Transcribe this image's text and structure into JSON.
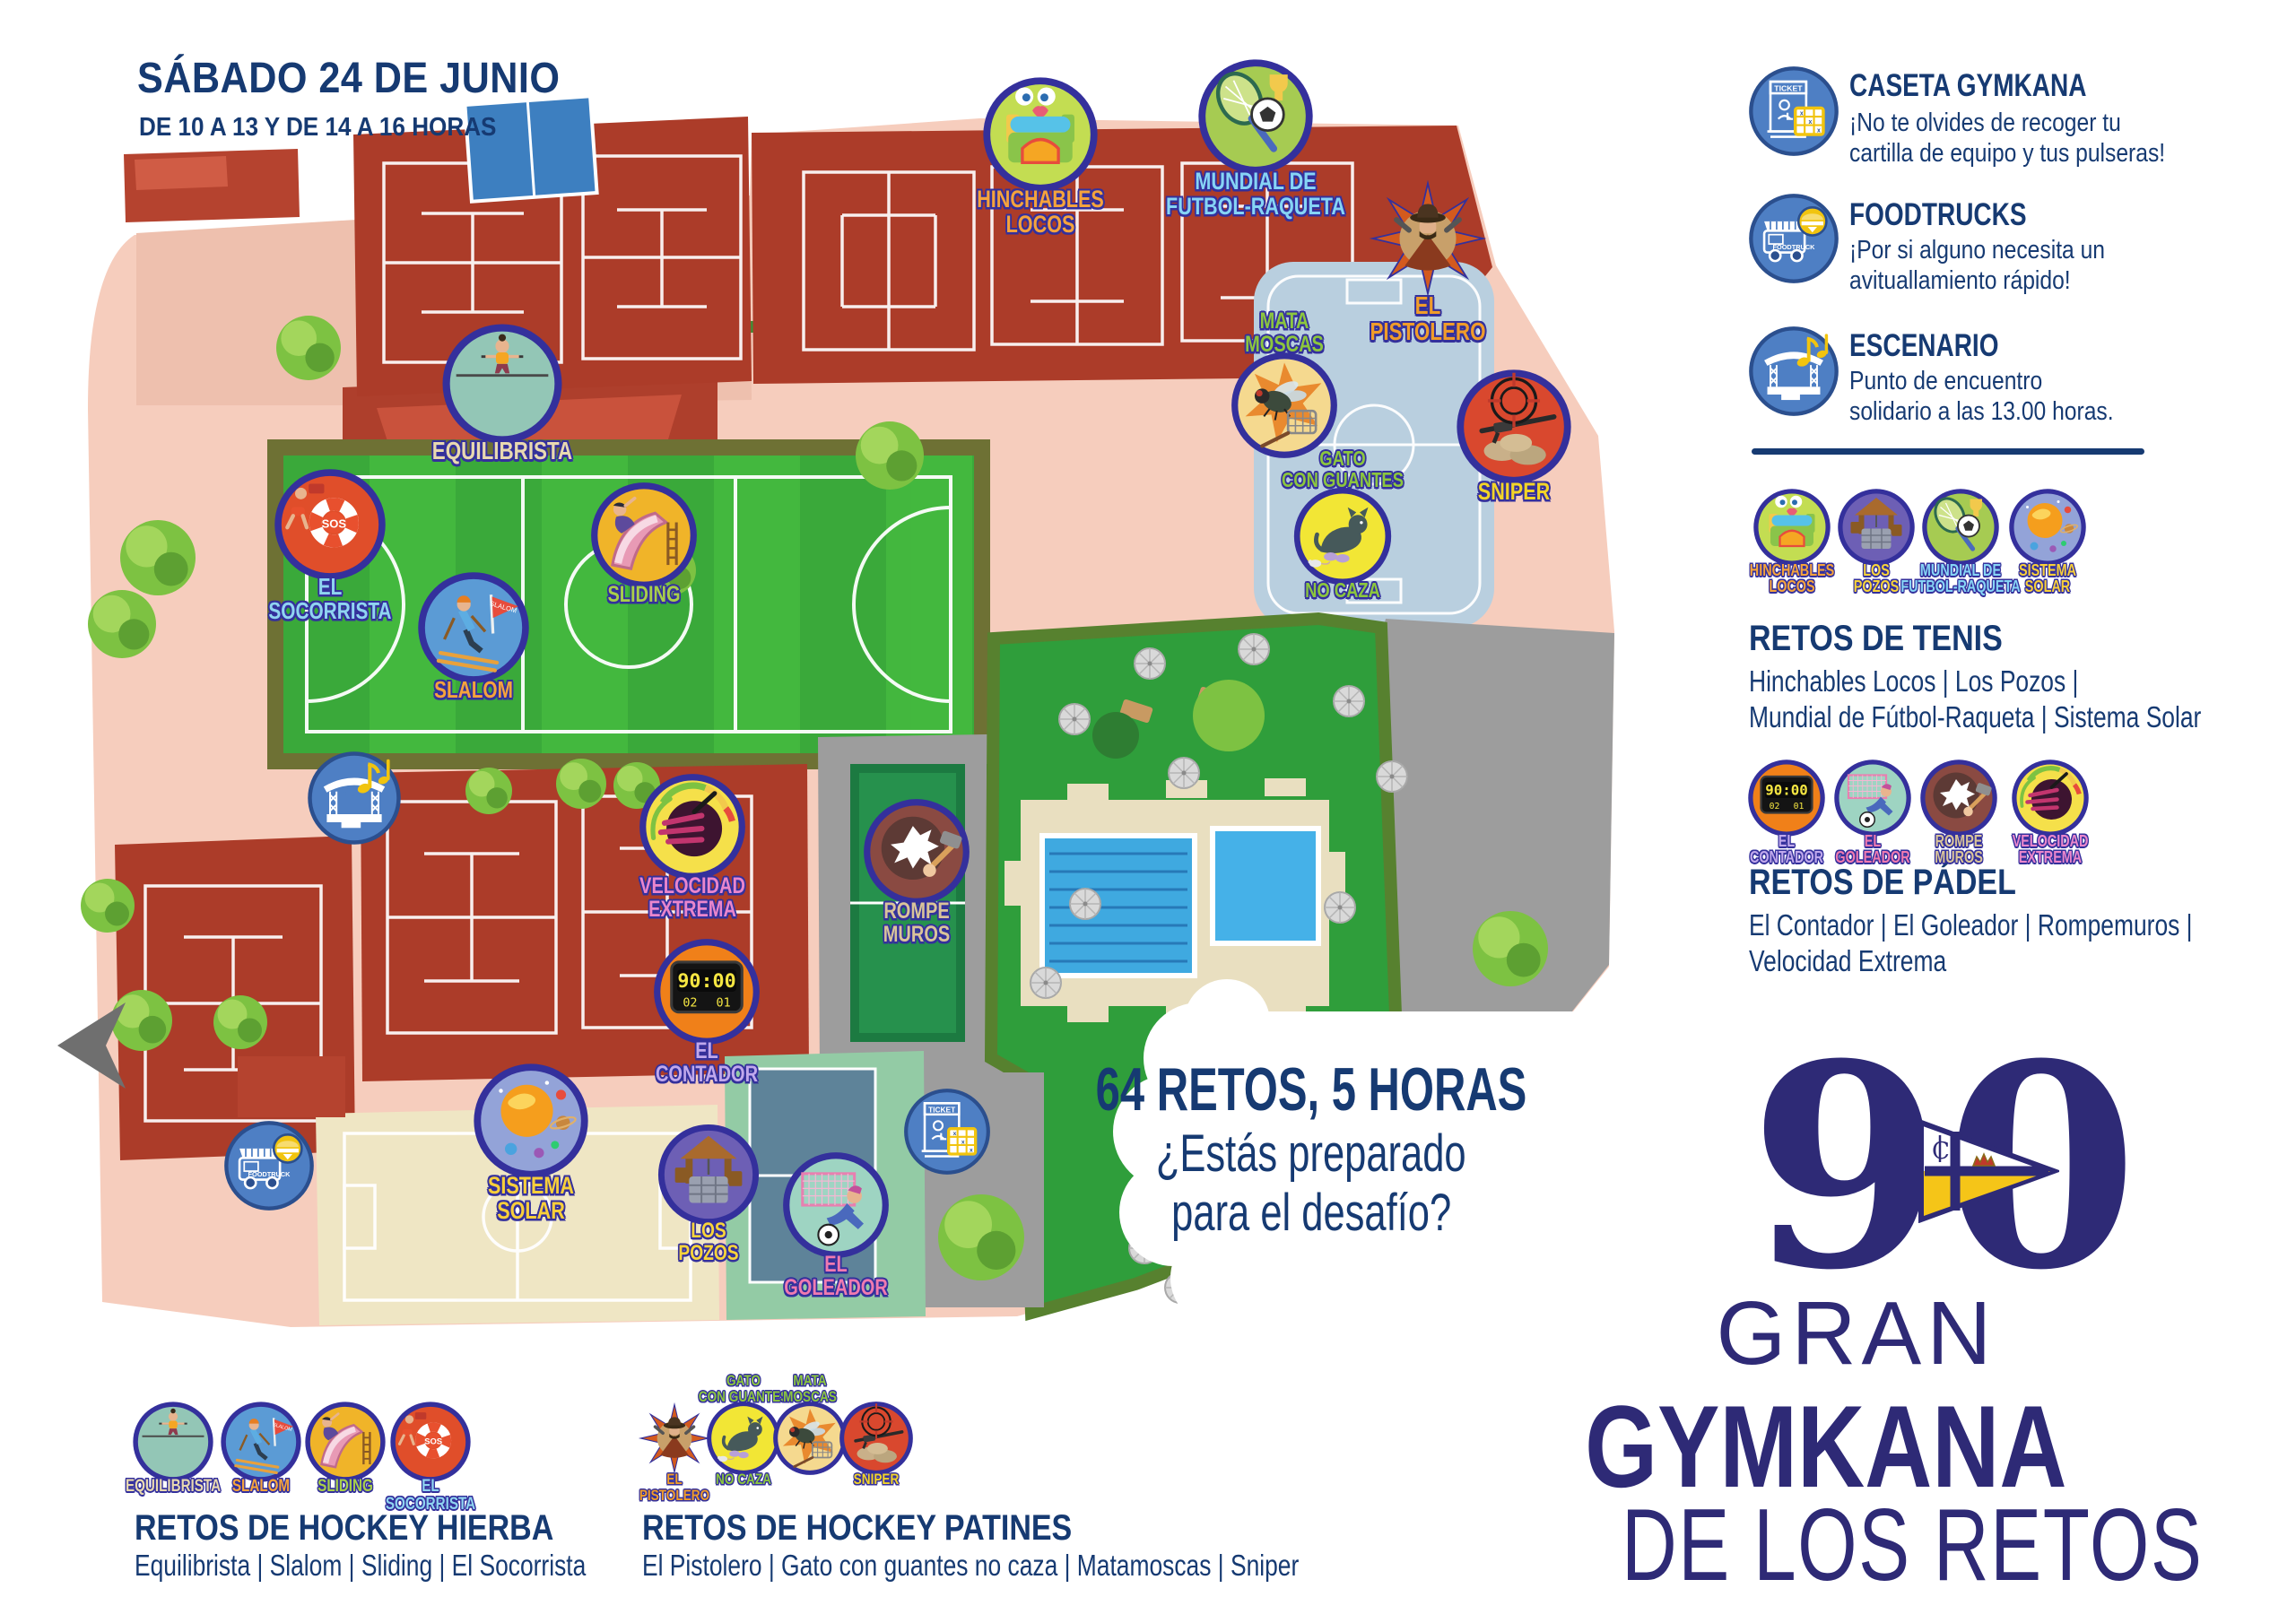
{
  "colors": {
    "navy": "#163a72",
    "indigo": "#2e2a76",
    "badge_ring": "#34309c",
    "legend_blue": "#4e7fc4",
    "legend_yellow": "#f1c40f"
  },
  "header": {
    "title": "SÁBADO 24 DE JUNIO",
    "subtitle": "DE 10 A 13 Y DE 14 A 16 HORAS"
  },
  "legend": [
    {
      "id": "caseta",
      "title": "CASETA GYMKANA",
      "desc": [
        "¡No te olvides de recoger tu",
        "cartilla de equipo y tus pulseras!"
      ],
      "icon": "ticket-booth",
      "icon_label": "TICKET"
    },
    {
      "id": "foodtrucks",
      "title": "FOODTRUCKS",
      "desc": [
        "¡Por si alguno necesita un",
        "avituallamiento rápido!"
      ],
      "icon": "foodtruck",
      "icon_label": "FOODTRUCK"
    },
    {
      "id": "escenario",
      "title": "ESCENARIO",
      "desc": [
        "Punto de encuentro",
        "solidario a las 13.00 horas."
      ],
      "icon": "stage-music",
      "icon_label": ""
    }
  ],
  "challenge_groups": [
    {
      "id": "tenis",
      "title": "RETOS DE TENIS",
      "lines": [
        "Hinchables Locos | Los Pozos |",
        "Mundial de Fútbol-Raqueta | Sistema Solar"
      ],
      "badges": [
        "hinchables-locos",
        "los-pozos",
        "mundial-futbol-raqueta",
        "sistema-solar"
      ]
    },
    {
      "id": "padel",
      "title": "RETOS DE PÁDEL",
      "lines": [
        "El Contador | El Goleador | Rompemuros |",
        "Velocidad Extrema"
      ],
      "badges": [
        "el-contador",
        "el-goleador",
        "rompe-muros",
        "velocidad-extrema"
      ]
    },
    {
      "id": "hockey-hierba",
      "title": "RETOS DE HOCKEY HIERBA",
      "lines": [
        "Equilibrista | Slalom | Sliding | El Socorrista"
      ],
      "badges": [
        "equilibrista",
        "slalom",
        "sliding",
        "el-socorrista"
      ]
    },
    {
      "id": "hockey-patines",
      "title": "RETOS DE HOCKEY PATINES",
      "lines": [
        "El Pistolero | Gato con guantes no caza | Matamoscas | Sniper"
      ],
      "badges": [
        "el-pistolero",
        "gato-con-guantes",
        "mata-moscas",
        "sniper"
      ]
    }
  ],
  "promo": {
    "line1": "64 RETOS, 5 HORAS",
    "line2": "¿Estás preparado",
    "line3": "para el desafío?"
  },
  "logo": {
    "number": "90",
    "line1": "GRAN",
    "line2": "GYMKANA",
    "line3": "DE LOS RETOS"
  },
  "badges": {
    "hinchables-locos": {
      "name": "Hinchables Locos",
      "above": [],
      "below": [
        "HINCHABLES",
        "LOCOS"
      ],
      "bg": "#c3dd52",
      "text": "#f5a33c",
      "motif": "castle"
    },
    "los-pozos": {
      "name": "Los Pozos",
      "above": [],
      "below": [
        "LOS",
        "POZOS"
      ],
      "bg": "#6d5fb5",
      "text": "#f8d43a",
      "motif": "well"
    },
    "mundial-futbol-raqueta": {
      "name": "Mundial de Fútbol-Raqueta",
      "above": [],
      "below": [
        "MUNDIAL DE",
        "FUTBOL-RAQUETA"
      ],
      "bg": "#a6cb52",
      "text": "#86d4f5",
      "motif": "racket"
    },
    "sistema-solar": {
      "name": "Sistema Solar",
      "above": [],
      "below": [
        "SISTEMA",
        "SOLAR"
      ],
      "bg": "#93a3d8",
      "text": "#f8cf3a",
      "motif": "planets"
    },
    "el-contador": {
      "name": "El Contador",
      "above": [],
      "below": [
        "EL",
        "CONTADOR"
      ],
      "bg": "#f08019",
      "text": "#c0a8ec",
      "motif": "scoreboard",
      "motif_text": {
        "time": "90:00",
        "home": "02",
        "away": "01"
      }
    },
    "el-goleador": {
      "name": "El Goleador",
      "above": [],
      "below": [
        "EL",
        "GOLEADOR"
      ],
      "bg": "#9ed4c2",
      "text": "#f07ab0",
      "motif": "goal"
    },
    "rompe-muros": {
      "name": "Rompemuros",
      "above": [],
      "below": [
        "ROMPE",
        "MUROS"
      ],
      "bg": "#8a4a42",
      "text": "#d9c49a",
      "motif": "wall"
    },
    "velocidad-extrema": {
      "name": "Velocidad Extrema",
      "above": [],
      "below": [
        "VELOCIDAD",
        "EXTREMA"
      ],
      "bg": "#f5e04a",
      "text": "#ea86cc",
      "motif": "speed"
    },
    "equilibrista": {
      "name": "Equilibrista",
      "above": [],
      "below": [
        "EQUILIBRISTA"
      ],
      "bg": "#93c6b6",
      "text": "#e8d9b0",
      "motif": "tightrope"
    },
    "slalom": {
      "name": "Slalom",
      "above": [],
      "below": [
        "SLALOM"
      ],
      "bg": "#5b9bd5",
      "text": "#f5a33c",
      "motif": "skier",
      "motif_text": {
        "flag": "SLALOM"
      }
    },
    "sliding": {
      "name": "Sliding",
      "above": [],
      "below": [
        "SLIDING"
      ],
      "bg": "#f0b429",
      "text": "#a8cf4a",
      "motif": "slide"
    },
    "el-socorrista": {
      "name": "El Socorrista",
      "above": [],
      "below": [
        "EL",
        "SOCORRISTA"
      ],
      "bg": "#e04e2a",
      "text": "#8fd4f0",
      "motif": "lifering",
      "motif_text": {
        "sos": "SOS"
      }
    },
    "el-pistolero": {
      "name": "El Pistolero",
      "above": [],
      "below": [
        "EL",
        "PISTOLERO"
      ],
      "bg": "#d35a1e",
      "text": "#f09c2a",
      "motif": "cowboy",
      "shape": "star"
    },
    "gato-con-guantes": {
      "name": "Gato con guantes no caza",
      "above": [
        "GATO",
        "CON GUANTES"
      ],
      "below": [
        "NO CAZA"
      ],
      "bg": "#f2e635",
      "text": "#8cc63e",
      "motif": "cat"
    },
    "mata-moscas": {
      "name": "Matamoscas",
      "above": [
        "MATA",
        "MOSCAS"
      ],
      "below": [],
      "bg": "#f5d98f",
      "text": "#8cc63e",
      "motif": "fly"
    },
    "sniper": {
      "name": "Sniper",
      "above": [],
      "below": [
        "SNIPER"
      ],
      "bg": "#d9482e",
      "text": "#f2d428",
      "motif": "crosshair"
    }
  },
  "map_icons": [
    {
      "id": "escenario-map",
      "icon": "stage-music",
      "label": ""
    },
    {
      "id": "foodtruck-map",
      "icon": "foodtruck",
      "label": "FOODTRUCK"
    },
    {
      "id": "ticket-map",
      "icon": "ticket-booth",
      "label": "TICKET"
    }
  ]
}
